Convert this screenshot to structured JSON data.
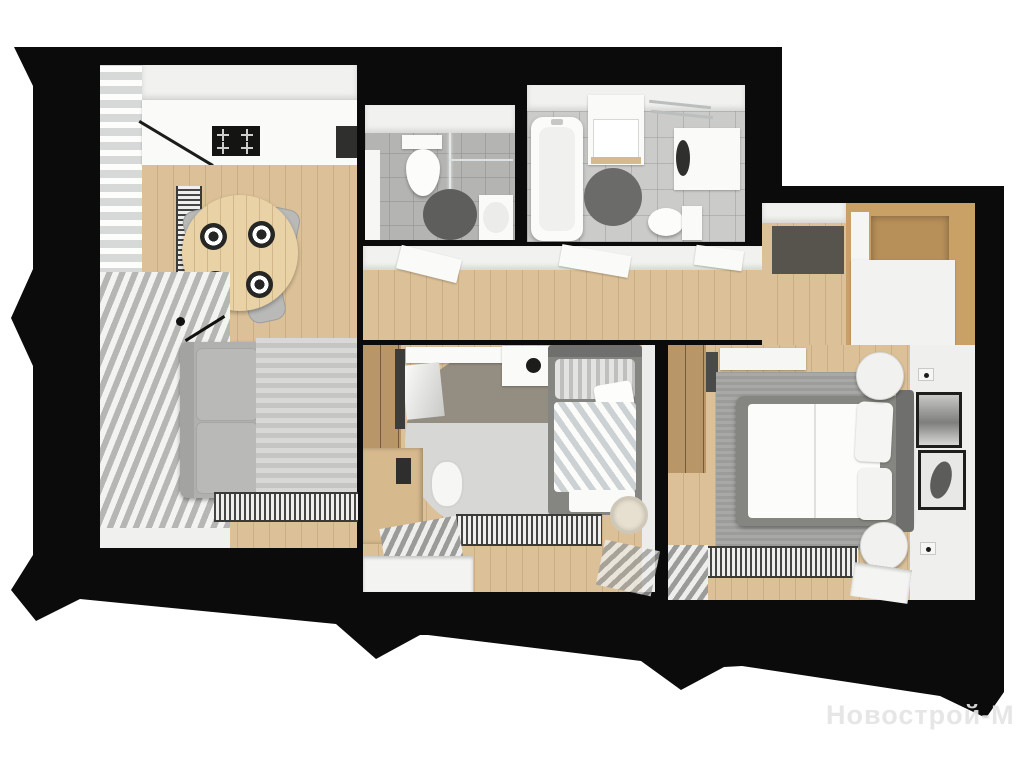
{
  "watermark": {
    "text": "Новострой-М"
  },
  "palette": {
    "background": "#ffffff",
    "wall_black": "#0b0b0b",
    "floor_wood": "#dcc198",
    "floor_wood_line": "#cbae83",
    "table_wood": "#e9d2a6",
    "wardrobe_wood": "#b99667",
    "entry_wood": "#c9a166",
    "desk_wood": "#d6b98c",
    "tile_gray": "#b4b4b2",
    "tile_light": "#cbcbc9",
    "ceiling_white": "#f1f1ef",
    "furniture_white": "#fafaf8",
    "sofa_gray": "#b0b0ae",
    "cushion_gray": "#b9b9b7",
    "chair_gray": "#b9b9b7",
    "rug_light": "#d8d8d6",
    "rug_stripe": "#c5c5c3",
    "rug_dark": "#5e5e5c",
    "rug_dark2": "#6b6b69",
    "rug_master": "#9c9c9a",
    "rug_two_tone_top": "#948d81",
    "bed_frame": "#858581",
    "headboard": "#6f6f6d",
    "doormat": "#57544e",
    "dark_appliance": "#2f2f2d",
    "black_accent": "#1c1c1a",
    "watermark_color": "rgba(228,228,228,0.92)"
  }
}
